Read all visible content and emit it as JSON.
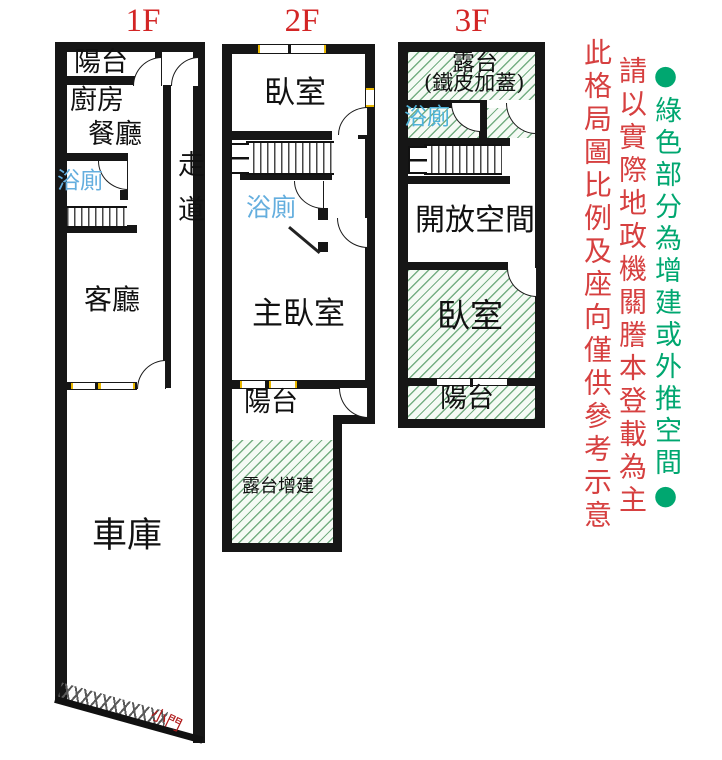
{
  "titles": {
    "f1": "1F",
    "f2": "2F",
    "f3": "3F"
  },
  "f1": {
    "balcony": "陽台",
    "kitchen": "廚房",
    "dining": "餐廳",
    "bath": "浴廁",
    "corridor": "走道",
    "living": "客廳",
    "garage": "車庫",
    "small_door": "小門"
  },
  "f2": {
    "bedroom": "臥室",
    "bath": "浴廁",
    "master_bedroom": "主臥室",
    "balcony": "陽台",
    "terrace_addition": "露台增建"
  },
  "f3": {
    "terrace": "露台",
    "terrace_note": "(鐵皮加蓋)",
    "bath": "浴廁",
    "open_space": "開放空間",
    "bedroom": "臥室",
    "balcony": "陽台"
  },
  "notes": {
    "green_note": "●綠色部分為增建或外推空間●",
    "red_note_registry": "請以實際地政機關謄本登載為主",
    "red_note_disclaimer": "此格局圖比例及座向僅供參考示意"
  },
  "legend_colors": {
    "annotation_red": "#d64040",
    "floor_title_red": "#d32525",
    "addition_green_hatch": "#6eaa7d",
    "green_note_text": "#00a770",
    "bath_label_blue": "#64aede",
    "window_tick_yellow": "#eab800",
    "wall_black": "#161616",
    "small_door_red": "#b01c1c"
  }
}
